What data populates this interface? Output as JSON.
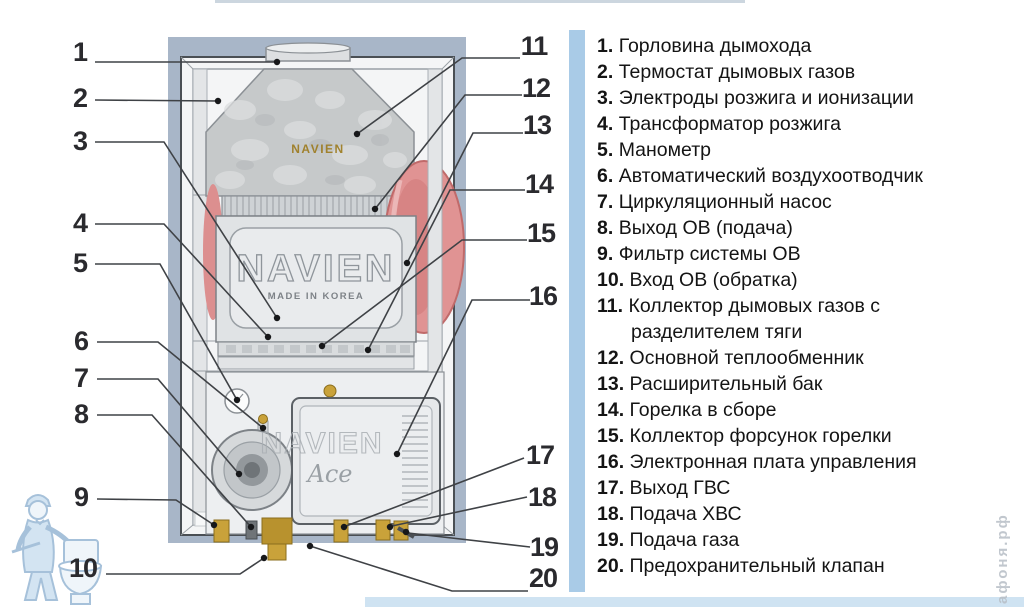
{
  "callouts": [
    "1",
    "2",
    "3",
    "4",
    "5",
    "6",
    "7",
    "8",
    "9",
    "10",
    "11",
    "12",
    "13",
    "14",
    "15",
    "16",
    "17",
    "18",
    "19",
    "20"
  ],
  "legend": {
    "items": [
      {
        "num": "1.",
        "text": "Горловина дымохода"
      },
      {
        "num": "2.",
        "text": "Термостат дымовых газов"
      },
      {
        "num": "3.",
        "text": "Электроды розжига и ионизации"
      },
      {
        "num": "4.",
        "text": "Трансформатор розжига"
      },
      {
        "num": "5.",
        "text": "Манометр"
      },
      {
        "num": "6.",
        "text": "Автоматический воздухоотводчик"
      },
      {
        "num": "7.",
        "text": "Циркуляционный насос"
      },
      {
        "num": "8.",
        "text": "Выход ОВ (подача)"
      },
      {
        "num": "9.",
        "text": "Фильтр системы ОВ"
      },
      {
        "num": "10.",
        "text": "Вход ОВ (обратка)"
      },
      {
        "num": "11.",
        "text": "Коллектор дымовых газов с разделителем тяги"
      },
      {
        "num": "12.",
        "text": "Основной теплообменник"
      },
      {
        "num": "13.",
        "text": "Расширительный бак"
      },
      {
        "num": "14.",
        "text": "Горелка в сборе"
      },
      {
        "num": "15.",
        "text": "Коллектор форсунок горелки"
      },
      {
        "num": "16.",
        "text": "Электронная плата управления"
      },
      {
        "num": "17.",
        "text": "Выход ГВС"
      },
      {
        "num": "18.",
        "text": "Подача ХВС"
      },
      {
        "num": "19.",
        "text": "Подача газа"
      },
      {
        "num": "20.",
        "text": "Предохранительный клапан"
      }
    ]
  },
  "boiler": {
    "brand_hood": "NAVIEN",
    "brand_chamber": "NAVIEN",
    "made_in": "MADE IN KOREA",
    "brand_panel": "NAVIEN",
    "model_script": "Ace"
  },
  "watermark": {
    "site_text": "афоня.рф"
  },
  "colors": {
    "panel_bg": "#a8b6c8",
    "divider_blue": "#a9cbe7",
    "bottom_bar_blue": "#cfe3f2",
    "expansion_tank_pink": "#e09393",
    "brass_fitting": "#c9a23a",
    "legend_text": "#141414",
    "callout_number": "#2a2a2e",
    "watermark_blue": "#9dbbd6"
  }
}
